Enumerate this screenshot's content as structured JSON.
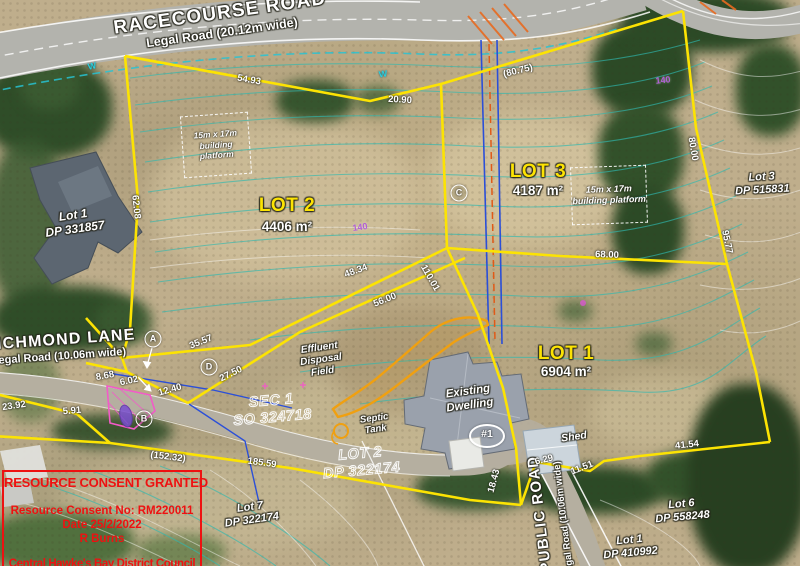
{
  "roads": {
    "racecourse": {
      "name": "RACECOURSE ROAD",
      "detail": "Legal Road (20.12m wide)"
    },
    "richmond": {
      "name": "RICHMOND LANE",
      "detail": "Legal Road (10.06m wide)"
    },
    "public": {
      "name": "PUBLIC ROAD",
      "detail": "Legal Road (10.06m wide)"
    }
  },
  "lots": {
    "lot1": {
      "label": "LOT 1",
      "area": "6904 m²"
    },
    "lot2": {
      "label": "LOT 2",
      "area": "4406 m²"
    },
    "lot3": {
      "label": "LOT 3",
      "area": "4187 m²"
    }
  },
  "adjoining": {
    "dp331857": {
      "line1": "Lot 1",
      "line2": "DP 331857"
    },
    "dp515831": {
      "line1": "Lot 3",
      "line2": "DP 515831"
    },
    "dp322174": {
      "line1": "Lot 7",
      "line2": "DP 322174"
    },
    "dp558248": {
      "line1": "Lot 6",
      "line2": "DP 558248"
    },
    "dp410992": {
      "line1": "Lot 1",
      "line2": "DP 410992"
    }
  },
  "parent_parcels": {
    "sec1": {
      "line1": "SEC 1",
      "line2": "SO 324718"
    },
    "lot2dp": {
      "line1": "LOT 2",
      "line2": "DP 322174"
    }
  },
  "platforms": {
    "line1": "15m x 17m",
    "line2": "building platform"
  },
  "features": {
    "effluent": [
      "Effluent",
      "Disposal",
      "Field"
    ],
    "septic": [
      "Septic",
      "Tank"
    ],
    "dwelling": [
      "Existing",
      "Dwelling"
    ],
    "dwelling_number": "#1",
    "shed": "Shed"
  },
  "markers": [
    {
      "t": "A",
      "x": 153,
      "y": 339
    },
    {
      "t": "D",
      "x": 209,
      "y": 367
    },
    {
      "t": "B",
      "x": 144,
      "y": 419
    },
    {
      "t": "C",
      "x": 459,
      "y": 193
    }
  ],
  "measurements": [
    {
      "t": "54.93",
      "x": 249,
      "y": 80,
      "r": 10
    },
    {
      "t": "20.90",
      "x": 400,
      "y": 100,
      "r": 3
    },
    {
      "t": "(80.75)",
      "x": 518,
      "y": 71,
      "r": -14
    },
    {
      "t": "62.08",
      "x": 136,
      "y": 207,
      "r": 84
    },
    {
      "t": "80.00",
      "x": 693,
      "y": 149,
      "r": 80
    },
    {
      "t": "95.77",
      "x": 727,
      "y": 242,
      "r": 78
    },
    {
      "t": "48.34",
      "x": 356,
      "y": 271,
      "r": -20
    },
    {
      "t": "56.00",
      "x": 385,
      "y": 300,
      "r": -22
    },
    {
      "t": "110.01",
      "x": 430,
      "y": 278,
      "r": 60
    },
    {
      "t": "68.00",
      "x": 607,
      "y": 255,
      "r": 2
    },
    {
      "t": "35.57",
      "x": 201,
      "y": 342,
      "r": -22
    },
    {
      "t": "27.50",
      "x": 231,
      "y": 374,
      "r": -26
    },
    {
      "t": "12.40",
      "x": 170,
      "y": 390,
      "r": -16
    },
    {
      "t": "8.68",
      "x": 105,
      "y": 376,
      "r": -10
    },
    {
      "t": "6.02",
      "x": 129,
      "y": 381,
      "r": -12
    },
    {
      "t": "23.92",
      "x": 14,
      "y": 406,
      "r": -8
    },
    {
      "t": "5.91",
      "x": 72,
      "y": 411,
      "r": -5
    },
    {
      "t": "(152.32)",
      "x": 168,
      "y": 457,
      "r": 7
    },
    {
      "t": "185.59",
      "x": 262,
      "y": 463,
      "r": 8
    },
    {
      "t": "41.54",
      "x": 687,
      "y": 445,
      "r": -6
    },
    {
      "t": "11.51",
      "x": 582,
      "y": 468,
      "r": -22
    },
    {
      "t": "6.29",
      "x": 544,
      "y": 460,
      "r": -14
    },
    {
      "t": "18.43",
      "x": 494,
      "y": 481,
      "r": -75
    }
  ],
  "contour_labels": [
    {
      "t": "140",
      "x": 360,
      "y": 227,
      "r": -8
    },
    {
      "t": "140",
      "x": 663,
      "y": 80,
      "r": -6
    }
  ],
  "water_symbols": [
    {
      "t": "W",
      "x": 383,
      "y": 74,
      "r": -8
    },
    {
      "t": "W",
      "x": 92,
      "y": 66,
      "r": -12
    }
  ],
  "stamp": {
    "title": "RESOURCE CONSENT GRANTED",
    "number": "Resource Consent No: RM220011",
    "date": "Date 25/2/2022",
    "officer": "R Burns",
    "council": "Central Hawke's Bay District Council"
  },
  "colors": {
    "boundary_yellow": "#fce303",
    "contour_cyan": "#2fb9b0",
    "service_blue": "#2b4fd8",
    "effluent_orange": "#f0a010",
    "easement_pink": "#f25ac8",
    "stamp_red": "#ee1111"
  }
}
